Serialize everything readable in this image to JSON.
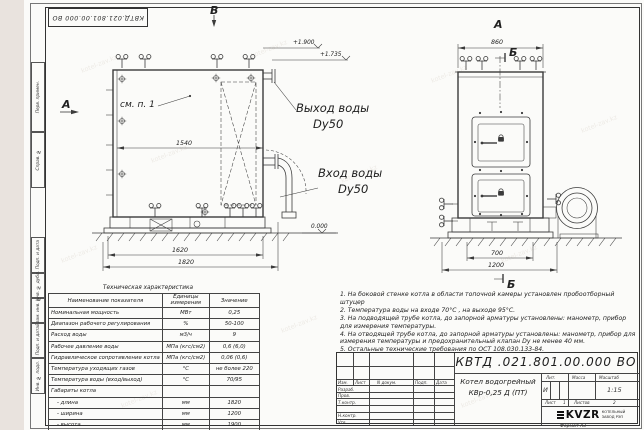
{
  "sheet": {
    "designation_top": "КВТД.021.801.00.000 ВО",
    "format_label": "Формат  А3",
    "watermark": "kotel-zav.kz"
  },
  "frame_left": {
    "labels": [
      "Перв. примен.",
      "Справ. №",
      "Подп. и дата",
      "Инв. № дубл.",
      "Взам. инв. №",
      "Подп. и дата",
      "Инв. № подл."
    ]
  },
  "views": {
    "front": {
      "view_letter": "В",
      "direction_letter": "А",
      "see_note": "см. п. 1",
      "dim_inner": "1540",
      "dim_base": "1620",
      "dim_overall": "1820",
      "level_top": "+1.900",
      "level_mid": "+1.735",
      "level_zero": "0.000",
      "outlet_label": "Выход воды",
      "outlet_dn": "Dy50",
      "inlet_label": "Вход воды",
      "inlet_dn": "Dy50"
    },
    "side": {
      "view_letter": "А",
      "section_letter_top": "Б",
      "section_letter_bottom": "Б",
      "dim_width": "860",
      "dim_base": "700",
      "dim_overall": "1200"
    }
  },
  "spec_table": {
    "title": "Техническая характеристика",
    "col_name": "Наименование показателя",
    "col_unit": "Единицы измерения",
    "col_value": "Значение",
    "rows": [
      {
        "name": "Номинальная мощность",
        "unit": "МВт",
        "value": "0,25"
      },
      {
        "name": "Диапазон рабочего регулирования",
        "unit": "%",
        "value": "50-100"
      },
      {
        "name": "Расход воды",
        "unit": "м3/ч",
        "value": "9"
      },
      {
        "name": "Рабочее давление воды",
        "unit": "МПа (кгс/см2)",
        "value": "0,6 (6,0)"
      },
      {
        "name": "Гидравлическое сопротивление котла",
        "unit": "МПа (кгс/см2)",
        "value": "0,06 (0,6)"
      },
      {
        "name": "Температура уходящих газов",
        "unit": "°С",
        "value": "не более 220"
      },
      {
        "name": "Температура воды (вход/выход)",
        "unit": "°С",
        "value": "70/95"
      },
      {
        "name": "Габариты котла",
        "unit": "",
        "value": ""
      },
      {
        "name": "- длина",
        "unit": "мм",
        "value": "1820"
      },
      {
        "name": "- ширина",
        "unit": "мм",
        "value": "1200"
      },
      {
        "name": "- высота",
        "unit": "мм",
        "value": "1900"
      }
    ]
  },
  "notes": {
    "items": [
      "1.  На боковой стенке котла в области топочной камеры установлен пробоотборный штуцер",
      "2.  Температура воды на входе  70°С , на выходе  95°С.",
      "3.  На подводящей трубе котла, до запорной арматуры установлены:  манометр, прибор для измерения температуры.",
      "4.  На отводящей трубе котла, до запорной арматуры установлены:  манометр, прибор для измерения температуры и предохранительный клапан  Dy не менее  40 мм.",
      "5.  Остальные технические требования по ОСТ 108.030.133-84."
    ]
  },
  "title_block": {
    "designation": "КВТД .021.801.00.000  ВО",
    "doc_title_line1": "Котел водогрейный",
    "doc_title_line2": "КВр-0,25  Д  (ПТ)",
    "col_izm": "Изм.",
    "col_list": "Лист",
    "col_ndoc": "N докум.",
    "col_podp": "Подп.",
    "col_data": "Дата",
    "row_labels": [
      "Разраб.",
      "Пров.",
      "Т.контр.",
      "Н.контр.",
      "Утв."
    ],
    "lit_label": "Лит.",
    "mass_label": "Масса",
    "scale_label": "Масштаб",
    "lit_value": "И",
    "scale_value": "1:15",
    "sheet_label": "Лист",
    "sheet_value": "1",
    "sheets_label": "Листов",
    "sheets_value": "2",
    "logo_text": "KVZR",
    "logo_sub1": "КОТЕЛЬНЫЙ",
    "logo_sub2": "ЗАВОД РЭП"
  }
}
